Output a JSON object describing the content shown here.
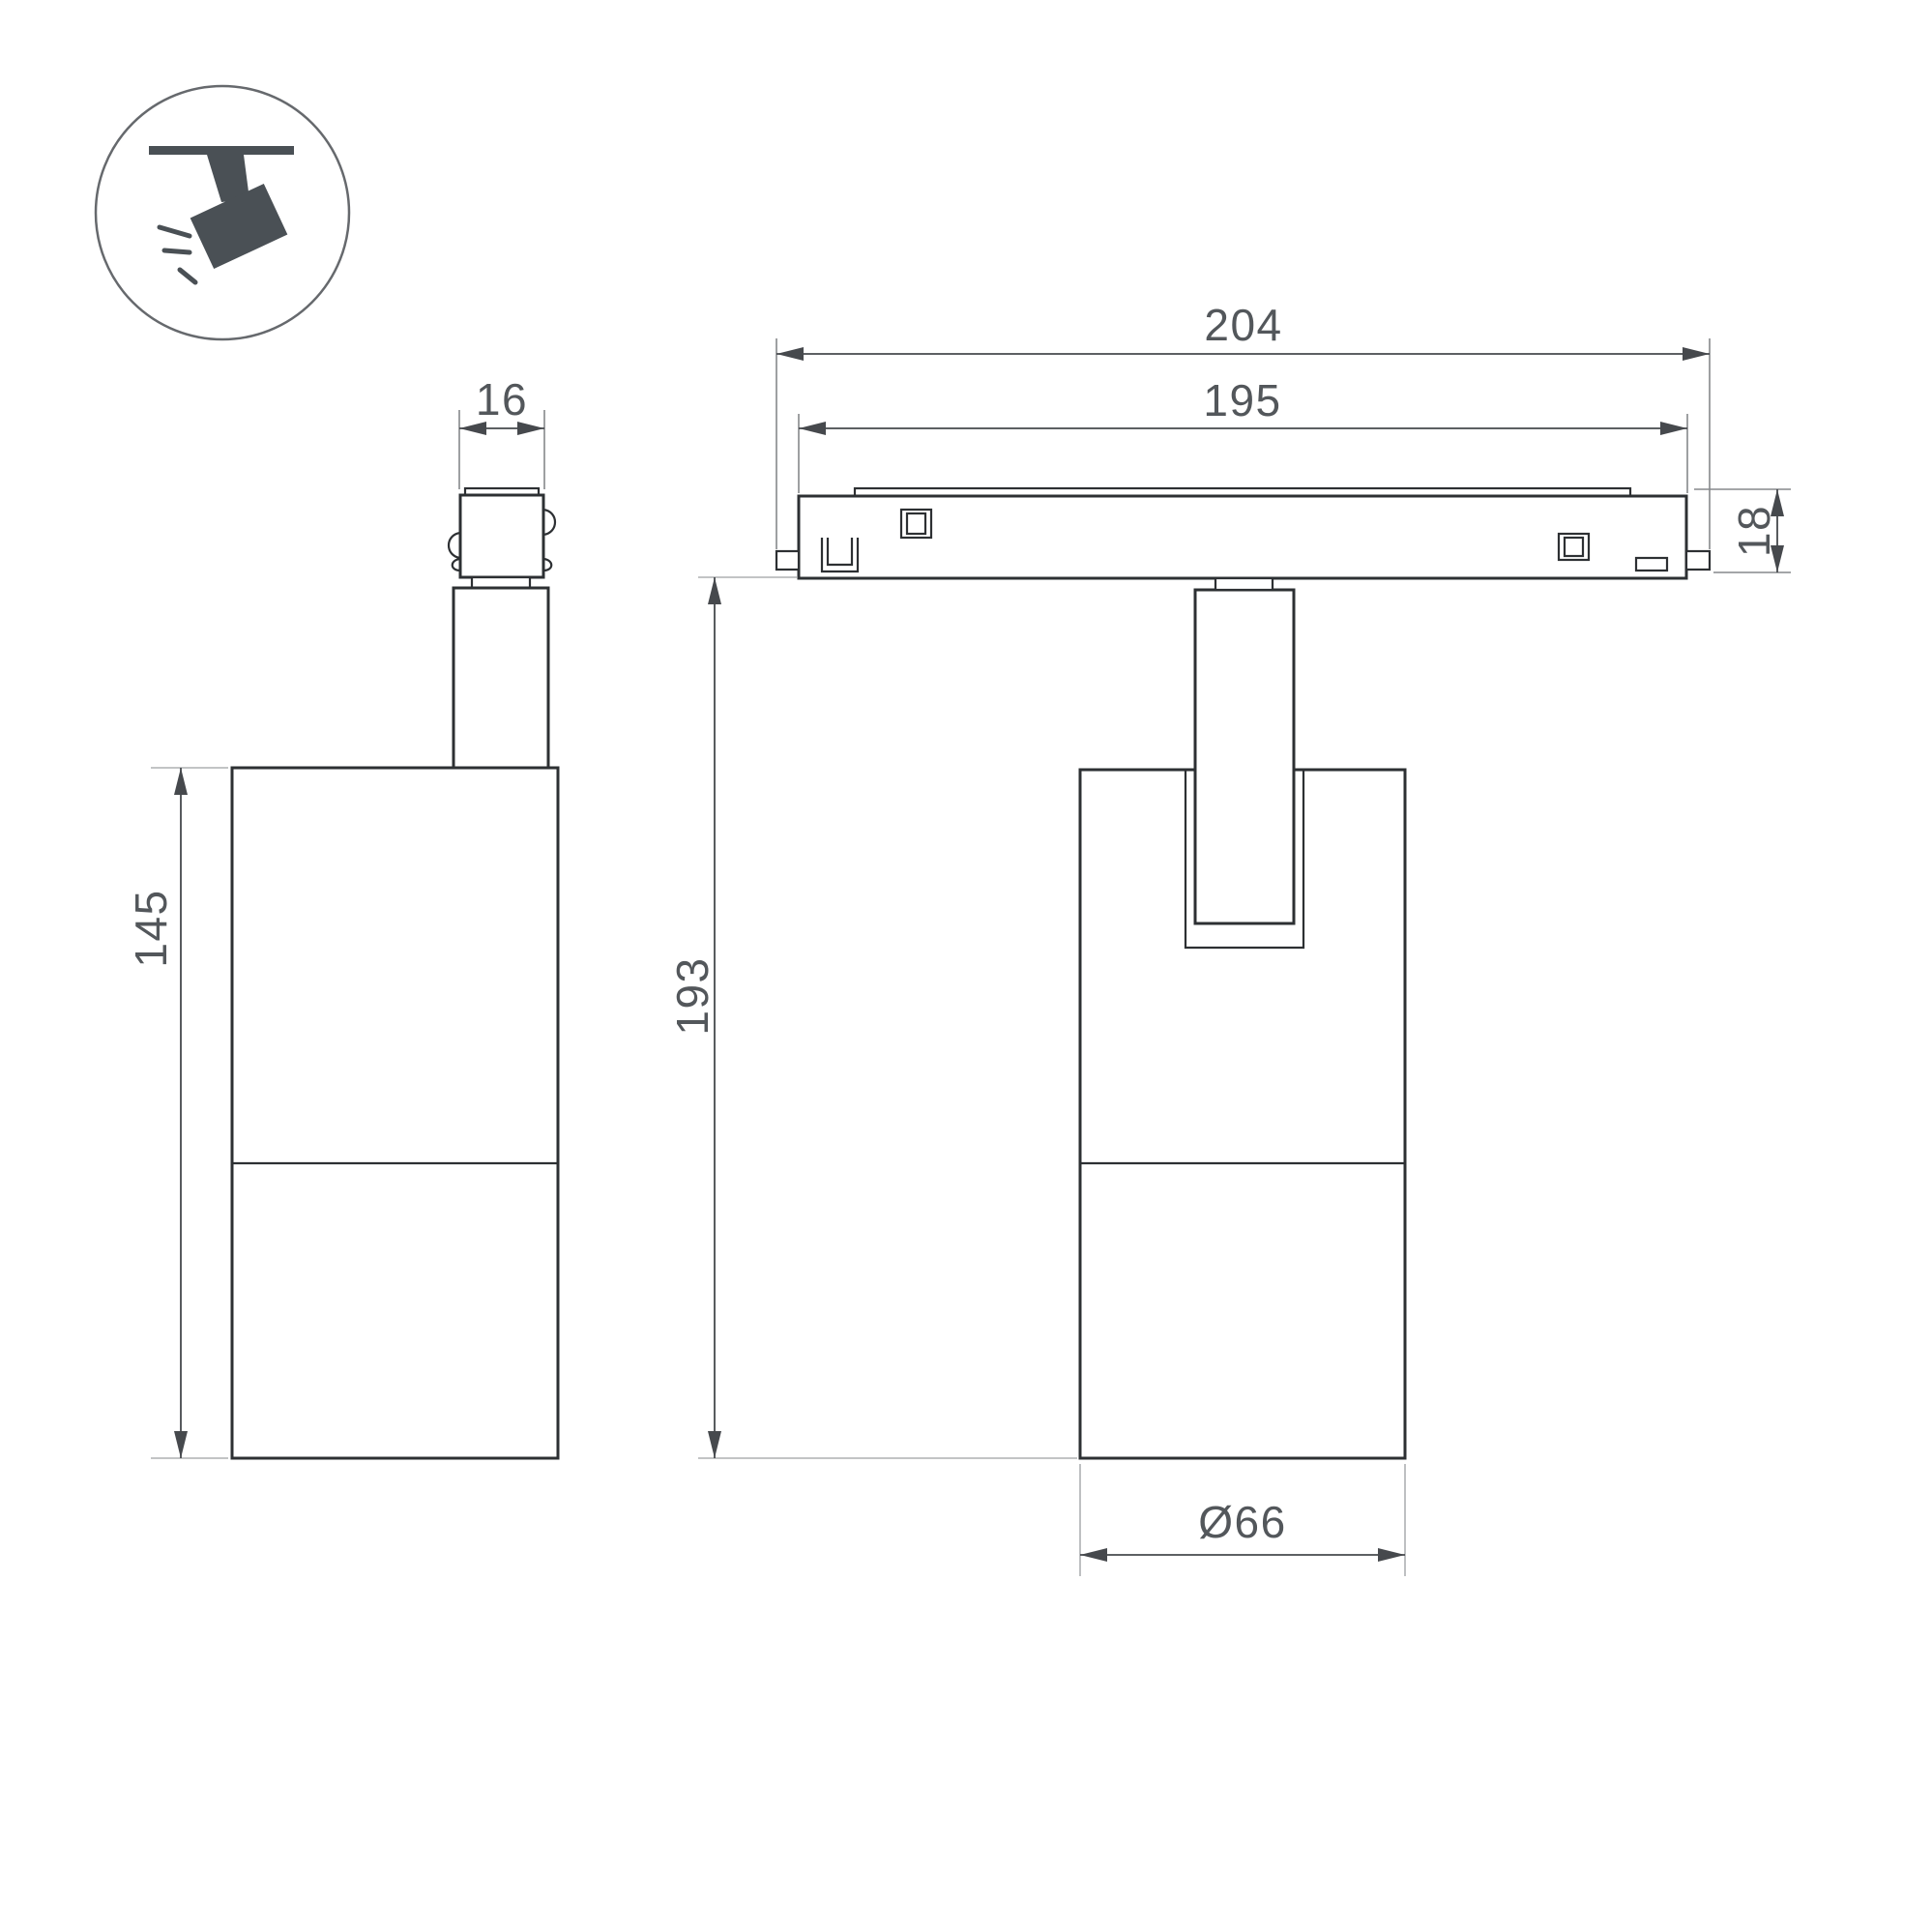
{
  "drawing": {
    "type": "technical-dimension-drawing",
    "subject": "magnetic track spotlight, side view and front view",
    "icon": "ceiling-track-spotlight",
    "colors": {
      "background": "#ffffff",
      "outline": "#2d3033",
      "dimension_line": "#46494d",
      "extension_line": "#85888b",
      "label_text": "#53575b",
      "icon_fill": "#4a5055"
    },
    "labels": {
      "adapter_width": "16",
      "body_height": "145",
      "track_outer_length": "204",
      "track_inner_length": "195",
      "track_height": "18",
      "overall_height": "193",
      "body_diameter": "Ø66"
    }
  }
}
